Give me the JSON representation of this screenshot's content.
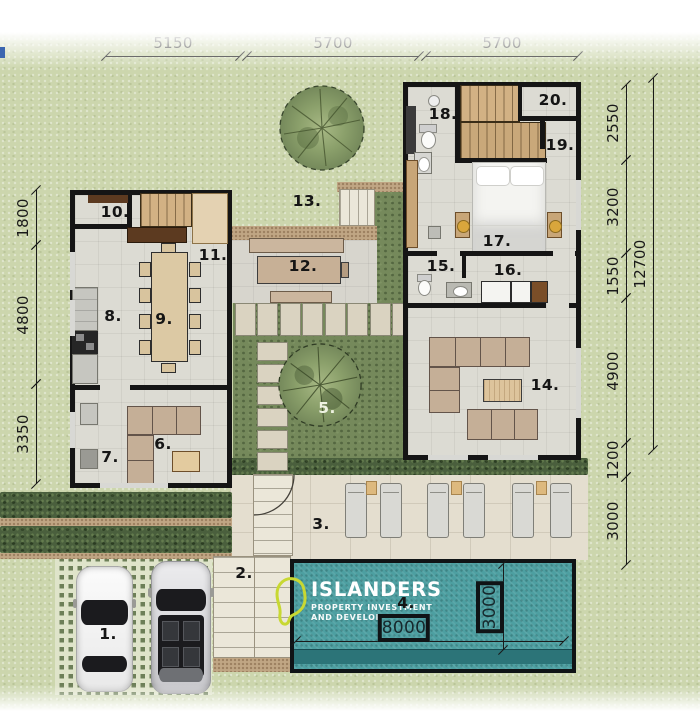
{
  "logo": {
    "name": "ISLANDERS",
    "tagline_line1": "PROPERTY INVESTMENT",
    "tagline_line2": "AND DEVELOPMENT",
    "mark_color": "#c8d832"
  },
  "colors": {
    "grass": "#ccd6ad",
    "garden": "#75895b",
    "hedge": "#4a5f3d",
    "pool_water": "#4d9fa1",
    "pool_bench": "#2c7478",
    "wall": "#151515",
    "deck": "#e4decf",
    "wood": "#c8a678",
    "sofa": "#c5af97"
  },
  "room_labels": [
    {
      "num": "1.",
      "x": 108,
      "y": 634
    },
    {
      "num": "2.",
      "x": 244,
      "y": 573
    },
    {
      "num": "3.",
      "x": 321,
      "y": 524
    },
    {
      "num": "4.",
      "x": 406,
      "y": 603
    },
    {
      "num": "5.",
      "x": 327,
      "y": 408,
      "color": "#eef2e2"
    },
    {
      "num": "6.",
      "x": 163,
      "y": 444
    },
    {
      "num": "7.",
      "x": 110,
      "y": 457
    },
    {
      "num": "8.",
      "x": 113,
      "y": 316
    },
    {
      "num": "9.",
      "x": 164,
      "y": 319
    },
    {
      "num": "10.",
      "x": 115,
      "y": 212
    },
    {
      "num": "11.",
      "x": 213,
      "y": 255
    },
    {
      "num": "12.",
      "x": 303,
      "y": 266
    },
    {
      "num": "13.",
      "x": 307,
      "y": 201
    },
    {
      "num": "14.",
      "x": 545,
      "y": 385
    },
    {
      "num": "15.",
      "x": 441,
      "y": 266
    },
    {
      "num": "16.",
      "x": 508,
      "y": 270
    },
    {
      "num": "17.",
      "x": 497,
      "y": 241
    },
    {
      "num": "18.",
      "x": 443,
      "y": 114
    },
    {
      "num": "19.",
      "x": 560,
      "y": 145
    },
    {
      "num": "20.",
      "x": 553,
      "y": 100
    }
  ],
  "dimensions": {
    "horizontal": [
      {
        "y": 56,
        "items": [
          {
            "label": "5150",
            "x1": 106,
            "x2": 240
          },
          {
            "label": "5700",
            "x1": 247,
            "x2": 419
          },
          {
            "label": "5700",
            "x1": 426,
            "x2": 578
          }
        ]
      },
      {
        "y": 641,
        "cls": "pool",
        "items": [
          {
            "label": "8000",
            "x1": 296,
            "x2": 564,
            "cx": 404
          }
        ]
      }
    ],
    "vertical": [
      {
        "x": 36,
        "items": [
          {
            "label": "1800",
            "y1": 190,
            "y2": 245
          },
          {
            "label": "4800",
            "y1": 245,
            "y2": 384
          },
          {
            "label": "3350",
            "y1": 384,
            "y2": 484
          }
        ]
      },
      {
        "x": 626,
        "items": [
          {
            "label": "2550",
            "y1": 85,
            "y2": 160
          },
          {
            "label": "3200",
            "y1": 160,
            "y2": 253
          },
          {
            "label": "1550",
            "y1": 253,
            "y2": 298
          },
          {
            "label": "4900",
            "y1": 298,
            "y2": 443
          },
          {
            "label": "1200",
            "y1": 443,
            "y2": 477
          },
          {
            "label": "3000",
            "y1": 477,
            "y2": 565
          }
        ]
      },
      {
        "x": 653,
        "items": [
          {
            "label": "12700",
            "y1": 78,
            "y2": 450
          }
        ]
      },
      {
        "x": 503,
        "cls": "pool",
        "items": [
          {
            "label": "3000",
            "y1": 564,
            "y2": 650
          }
        ]
      }
    ]
  }
}
